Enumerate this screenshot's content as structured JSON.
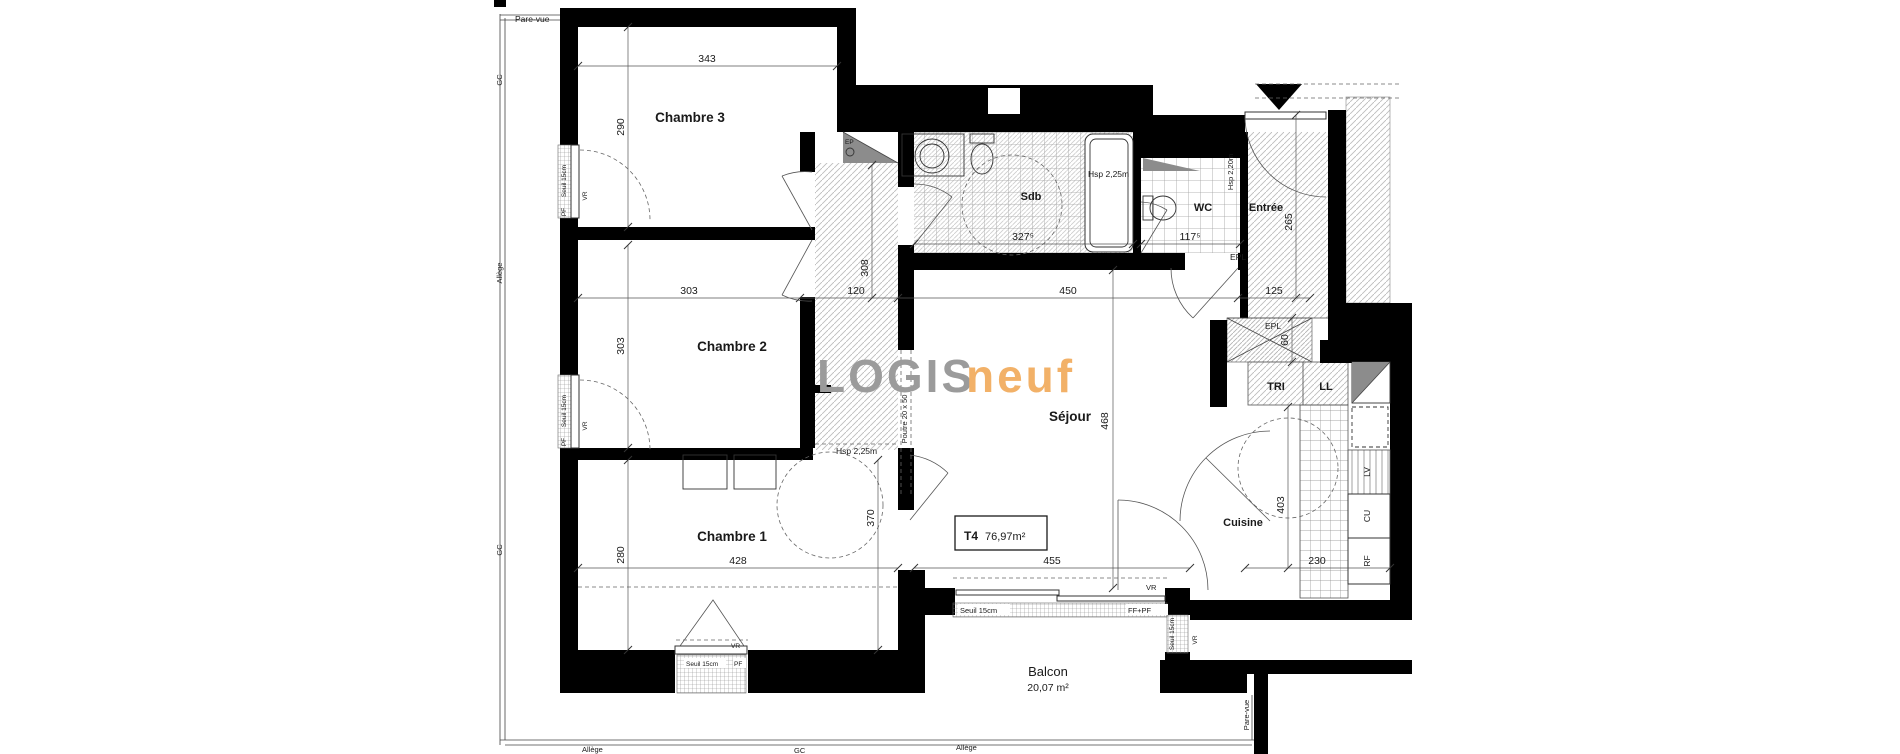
{
  "plan": {
    "logo": {
      "gray_part": "LOGIS",
      "orange_part": "neuf"
    },
    "title_box": {
      "type": "T4",
      "area": "76,97m²"
    },
    "rooms": {
      "chambre3": "Chambre 3",
      "chambre2": "Chambre 2",
      "chambre1": "Chambre 1",
      "sejour": "Séjour",
      "cuisine": "Cuisine",
      "sdb": "Sdb",
      "wc": "WC",
      "entree": "Entrée",
      "balcon": "Balcon",
      "balcon_area": "20,07 m²",
      "tri": "TRI",
      "ll": "LL",
      "lv": "LV",
      "cu": "CU",
      "rf": "RF"
    },
    "dims": {
      "c3_w": "343",
      "c3_h": "290",
      "c2_w": "303",
      "c2_h": "303",
      "c1_h": "280",
      "c1_w": "428",
      "hall_w": "120",
      "hall_h": "308",
      "sdb_w": "327⁵",
      "wc_w": "117⁵",
      "sejour_top": "450",
      "entree_w": "125",
      "entree_h": "265",
      "closet_h": "60",
      "c1_r": "370",
      "sejour_h": "468",
      "sejour_w": "455",
      "cuisine_h": "403",
      "cuisine_w": "230"
    },
    "annotations": {
      "pare_vue": "Pare-vue",
      "gc": "GC",
      "allege": "Allège",
      "ep": "EP",
      "epl": "EPL",
      "pf": "PF",
      "vr": "VR",
      "ff_pf": "FF+PF",
      "seuil": "Seuil 15cm",
      "hsp_225": "Hsp 2,25m",
      "hsp_220": "Hsp 2,20m",
      "poutre": "Poutre 20 x 50"
    },
    "colors": {
      "logo_gray": "#9b9b9b",
      "logo_orange": "#f2b168",
      "wall": "#000000",
      "gray_fill": "#8c8c8c"
    }
  }
}
